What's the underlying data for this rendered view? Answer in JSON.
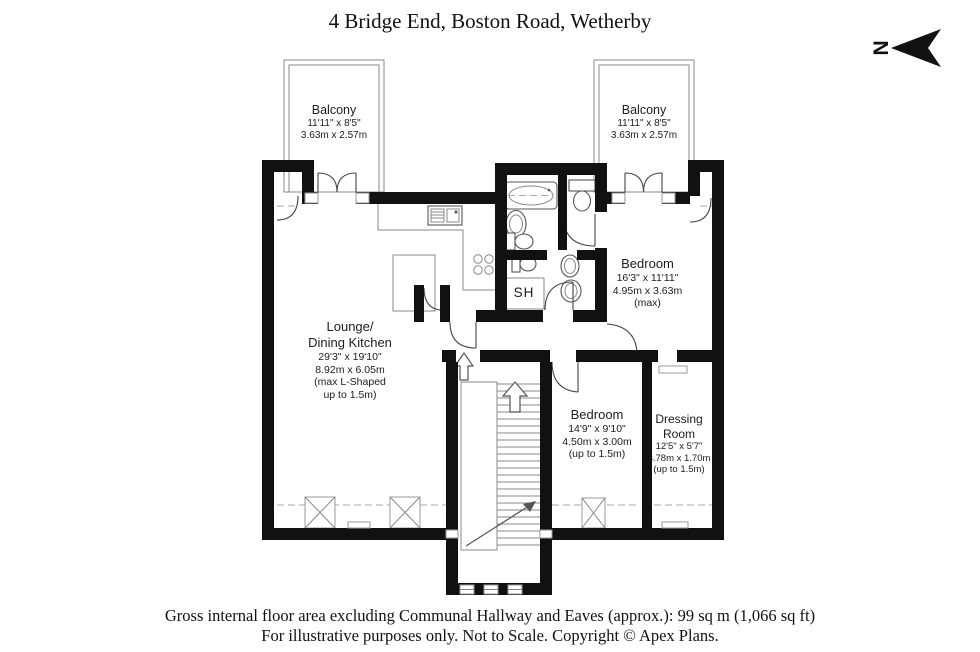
{
  "title": "4 Bridge End, Boston Road, Wetherby",
  "north": {
    "label": "N"
  },
  "rooms": {
    "balcony_left": {
      "name": "Balcony",
      "dims_ft": "11'11\" x 8'5\"",
      "dims_m": "3.63m x 2.57m"
    },
    "balcony_right": {
      "name": "Balcony",
      "dims_ft": "11'11\" x 8'5\"",
      "dims_m": "3.63m x 2.57m"
    },
    "lounge": {
      "name_line1": "Lounge/",
      "name_line2": "Dining Kitchen",
      "dims_ft": "29'3\" x 19'10\"",
      "dims_m": "8.92m x 6.05m",
      "note_line1": "(max L-Shaped",
      "note_line2": "up to 1.5m)"
    },
    "bedroom1": {
      "name": "Bedroom",
      "dims_ft": "16'3\" x 11'11\"",
      "dims_m": "4.95m x 3.63m",
      "note": "(max)"
    },
    "bedroom2": {
      "name": "Bedroom",
      "dims_ft": "14'9\" x 9'10\"",
      "dims_m": "4.50m x 3.00m",
      "note": "(up to 1.5m)"
    },
    "dressing": {
      "name_line1": "Dressing",
      "name_line2": "Room",
      "dims_ft": "12'5\" x 5'7\"",
      "dims_m": "3.78m x 1.70m",
      "note": "(up to 1.5m)"
    },
    "shower": {
      "label": "SH"
    }
  },
  "footer": {
    "line1": "Gross internal floor area excluding Communal Hallway and Eaves (approx.): 99 sq m (1,066 sq ft)",
    "line2": "For illustrative purposes only. Not to Scale. Copyright © Apex Plans."
  },
  "colors": {
    "wall": "#111111",
    "fixture_line": "#555555",
    "dashed_line": "#aaaaaa"
  }
}
